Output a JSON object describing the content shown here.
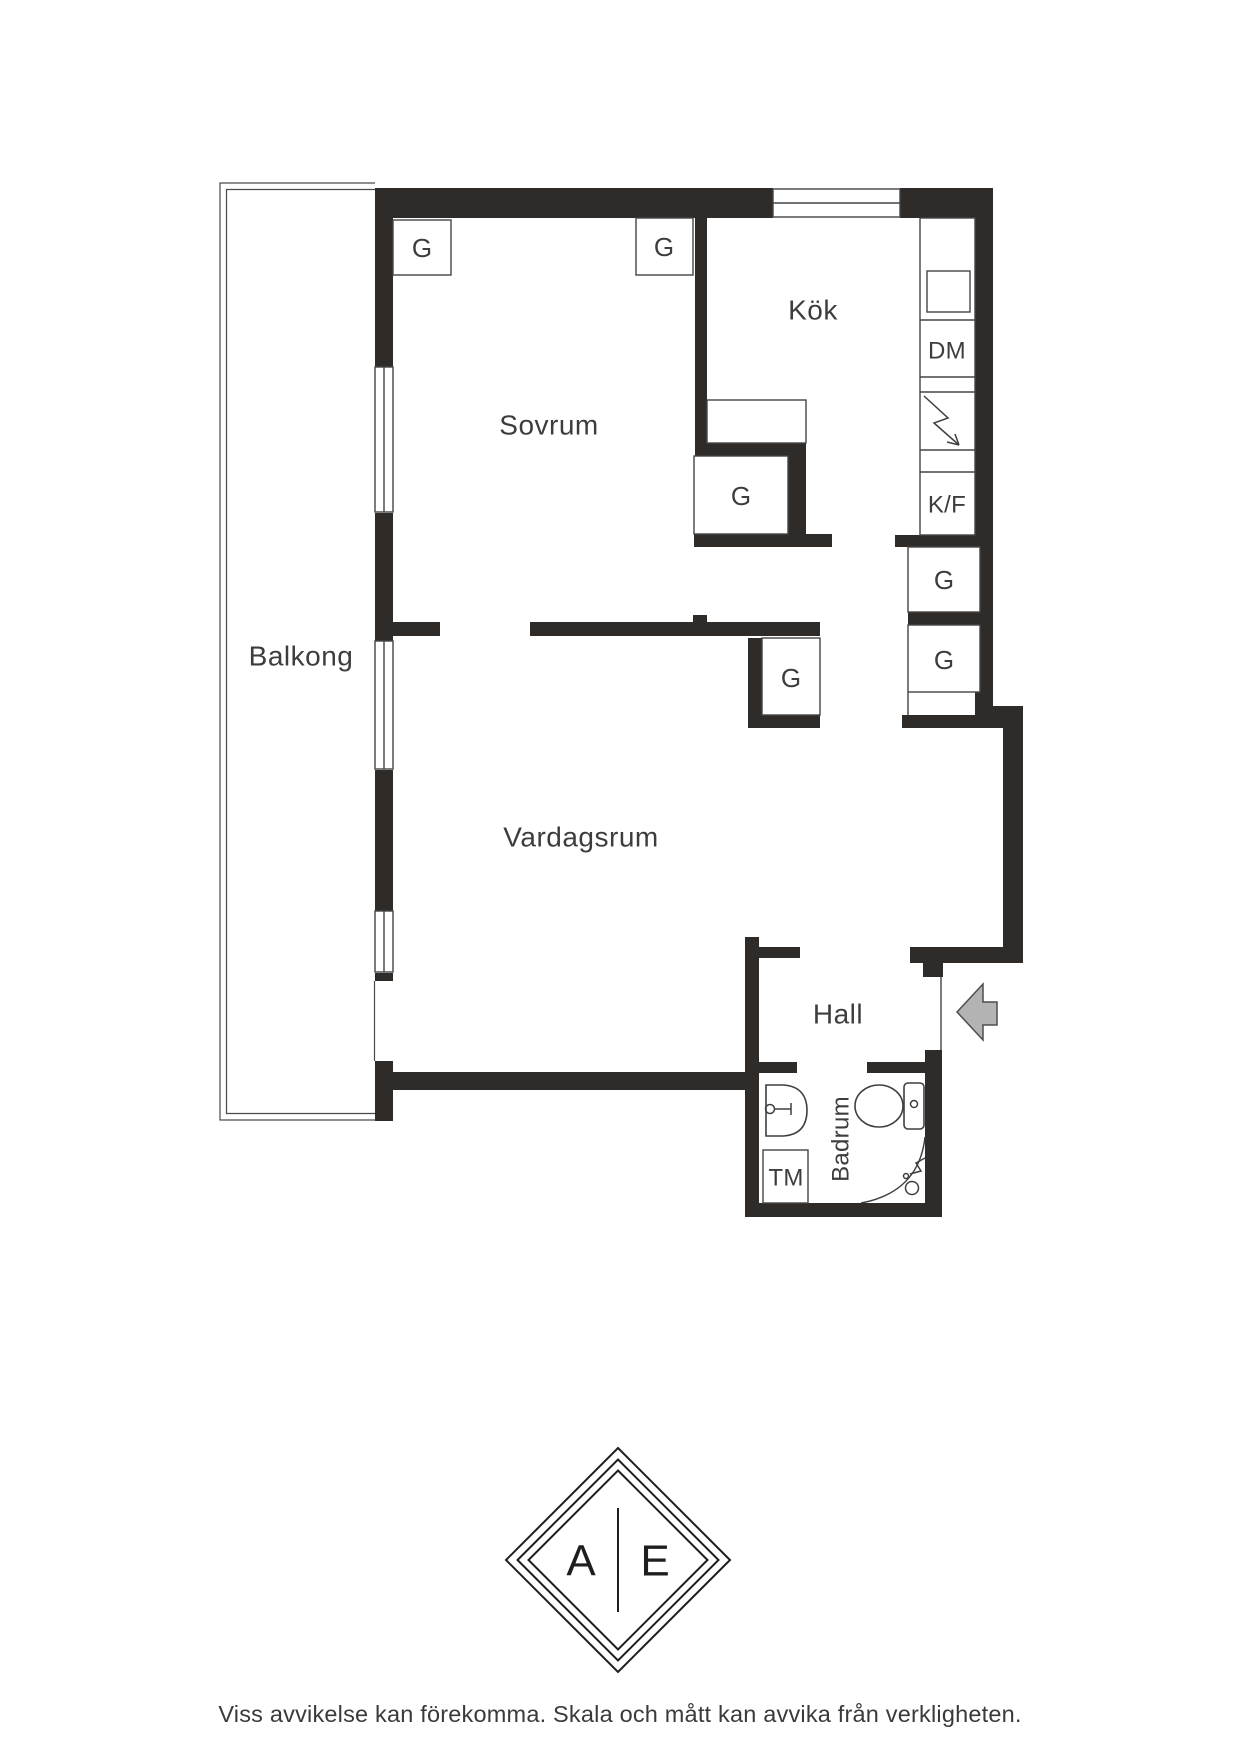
{
  "plan": {
    "wall_color": "#2e2b28",
    "line_color": "#454545",
    "entry_arrow_color": "#b3b3b3",
    "rooms": {
      "balcony": "Balkong",
      "bedroom": "Sovrum",
      "kitchen": "Kök",
      "living_room": "Vardagsrum",
      "hall": "Hall",
      "bathroom": "Badrum"
    },
    "closets": [
      "G",
      "G",
      "G",
      "G",
      "G",
      "G"
    ],
    "appliances": {
      "dishwasher": "DM",
      "fridge_freezer": "K/F",
      "washing_machine": "TM"
    }
  },
  "logo": {
    "left_letter": "A",
    "right_letter": "E"
  },
  "footer": {
    "disclaimer": "Viss avvikelse kan förekomma. Skala och mått kan avvika från verkligheten."
  }
}
